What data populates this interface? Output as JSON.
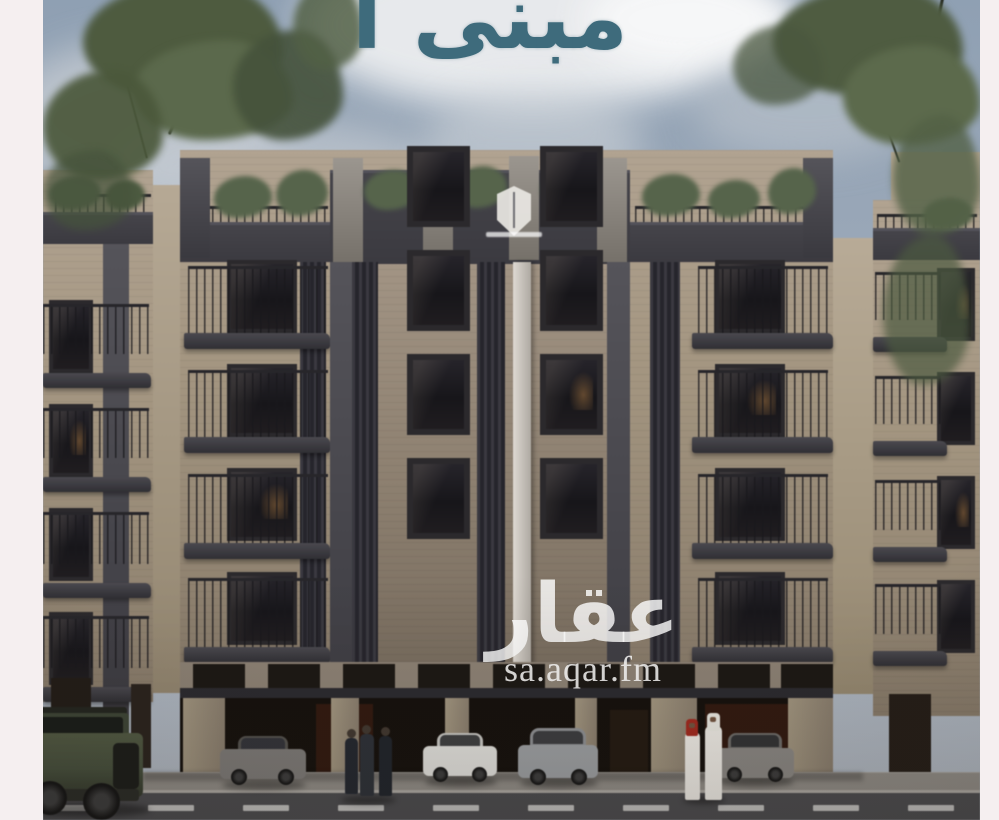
{
  "page": {
    "frame_color": "#f5eff0"
  },
  "photo": {
    "title": "مبنى أ",
    "title_color": "#3e6b7c"
  },
  "watermark": {
    "logo_text": "عقار",
    "site_url": "sa.aqar.fm",
    "text_color": "#ffffff"
  },
  "scene": {
    "sky": {
      "base_top": "#8fa0b3",
      "base_bottom": "#b3bac3",
      "cloud": "#eef0f2"
    },
    "greenery": "#55644a",
    "building": {
      "facade_beige": "#ab9d89",
      "parapet_dark": "#45444a",
      "window_glass": "#1c1a1d",
      "white_pilaster": "#d9d4cc",
      "garage_interior": "#15100c",
      "garage_column": "#9c8f7e",
      "wood_panel": "#32190e"
    },
    "developer_logo": {
      "shape": "white-shield",
      "color": "#e9e7e3"
    },
    "street": {
      "asphalt": "#4c4c4f",
      "sidewalk": "#918d87",
      "lane_marking": "#d8d7d3"
    },
    "vehicles": [
      {
        "name": "green-suv",
        "color": "#47503c"
      },
      {
        "name": "gray-sedan",
        "color": "#7e7b78"
      },
      {
        "name": "white-sedan",
        "color": "#e3e2de"
      },
      {
        "name": "silver-suv",
        "color": "#9da0a3"
      },
      {
        "name": "gray-hatchback",
        "color": "#8b8884"
      }
    ],
    "people": [
      {
        "name": "pedestrians-casual",
        "count": 3,
        "outfit_colors": [
          "#232730",
          "#2d3138",
          "#20242b"
        ]
      },
      {
        "name": "pedestrians-thobe",
        "count": 2,
        "outfit_color": "#f0ede7",
        "ghutra_colors": [
          "#a8271c",
          "#eceae3"
        ]
      }
    ]
  }
}
